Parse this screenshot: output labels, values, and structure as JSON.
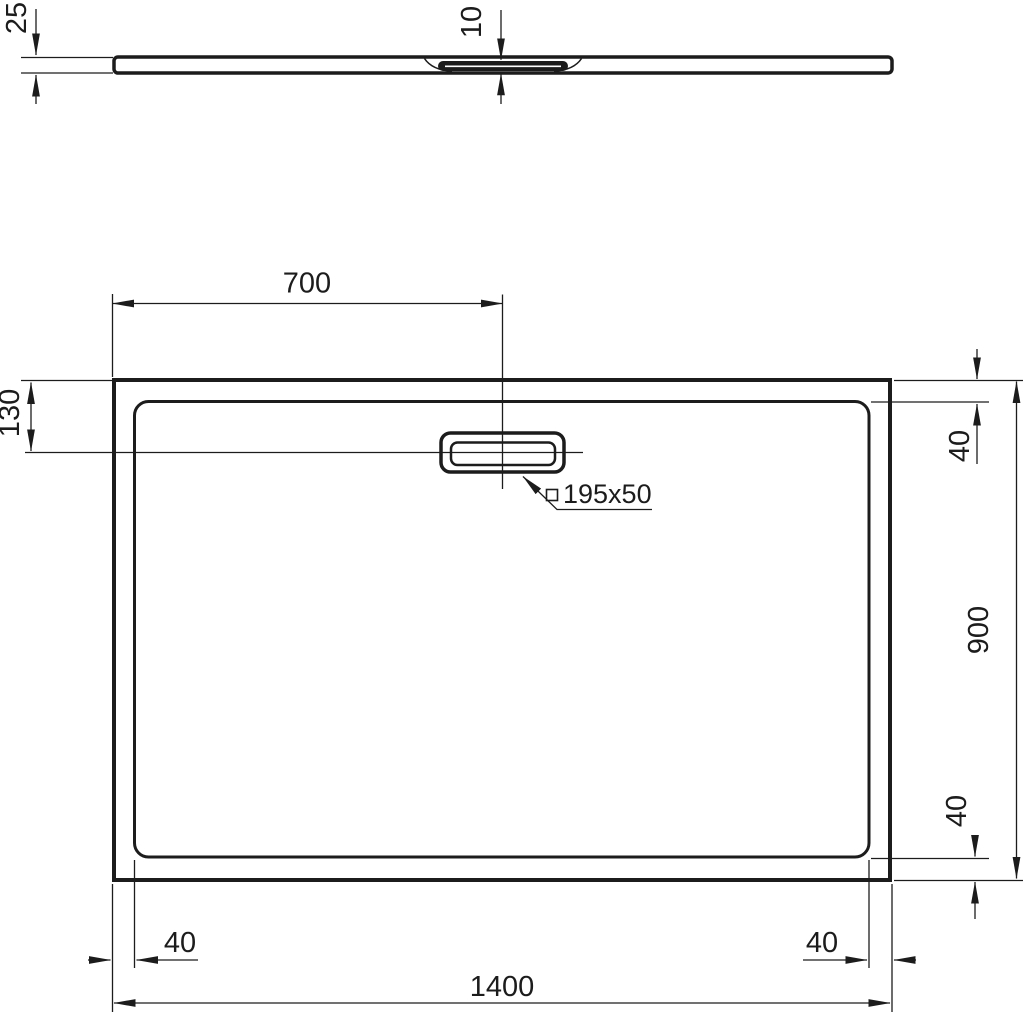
{
  "drawing": {
    "kind": "technical-drawing",
    "subject": "rectangular shower tray with rectangular waste, side profile view above and plan view below"
  },
  "colors": {
    "line": "#1c1c1c",
    "background": "#ffffff"
  },
  "dims": {
    "profile_thickness": "25",
    "profile_recess_depth": "10",
    "plan_drain_center_from_left": "700",
    "plan_drain_center_from_top": "130",
    "plan_rim_inset_top_right": "40",
    "plan_width": "900",
    "plan_rim_inset_bottom_right_vertical": "40",
    "plan_rim_inset_bottom_left": "40",
    "plan_rim_inset_bottom_right_horizontal": "40",
    "plan_length": "1400",
    "waste_size": "195x50"
  },
  "symbols": {
    "waste_shape": "square-outline"
  }
}
